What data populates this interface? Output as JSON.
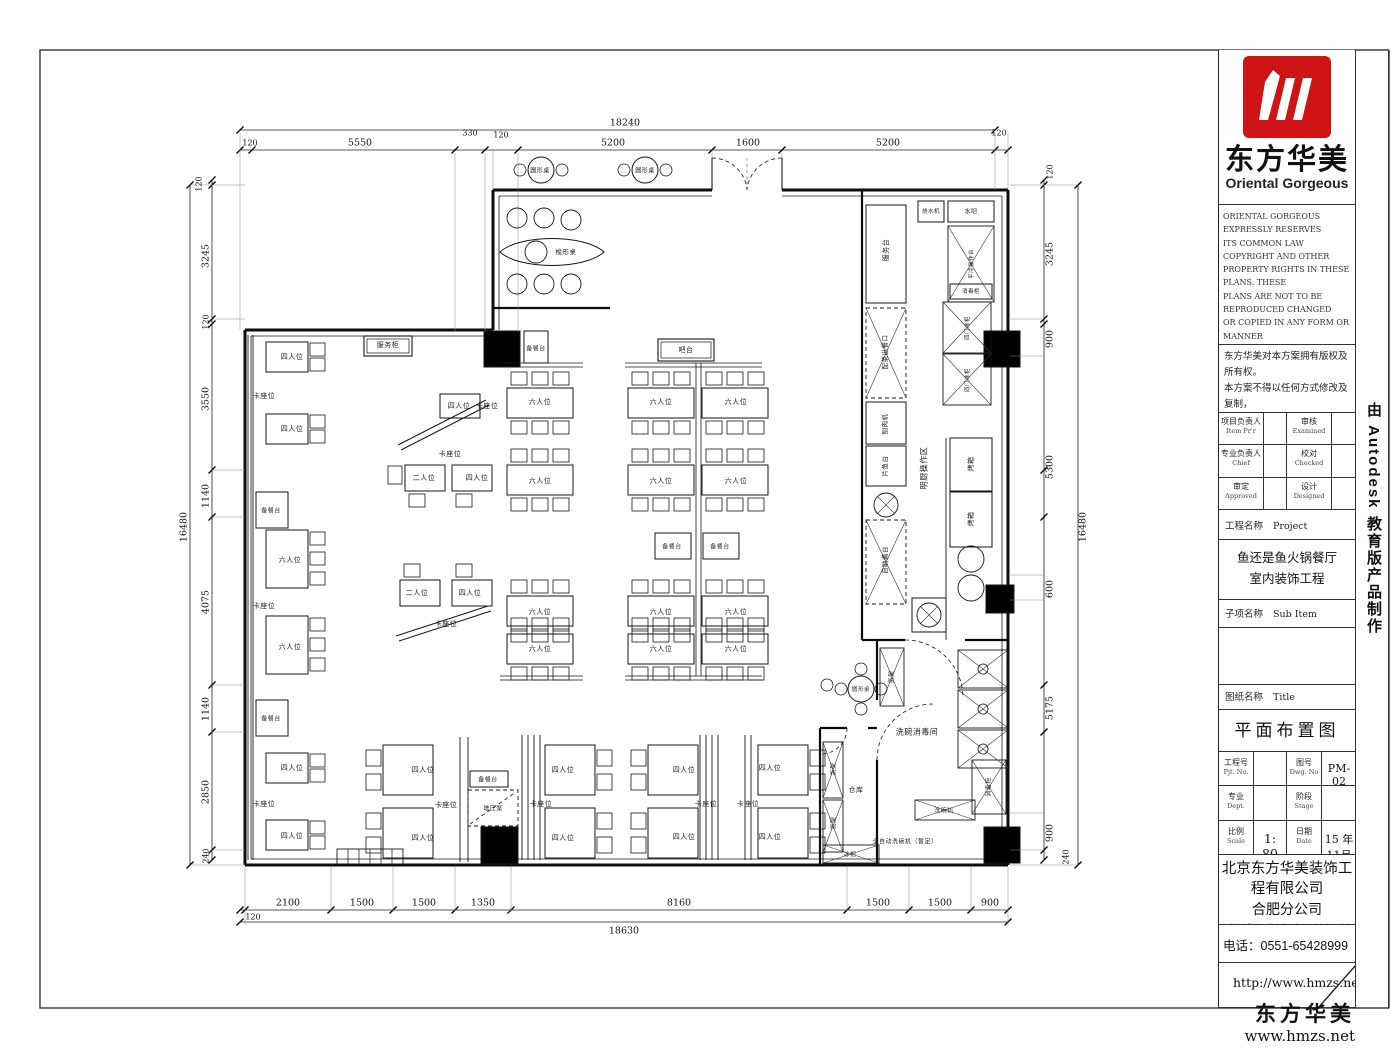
{
  "colors": {
    "logo_red": "#ce1414"
  },
  "sheet": {
    "brand": {
      "logo_cn": "东方华美",
      "logo_en": "Oriental Gorgeous"
    },
    "copyright_en": [
      "ORIENTAL GORGEOUS EXPRESSLY RESERVES",
      "ITS COMMON LAW COPYRIGHT AND OTHER",
      "PROPERTY RIGHTS IN THESE PLANS. THESE",
      "PLANS ARE NOT TO BE REPRODUCED CHANGED",
      "OR COPIED IN ANY FORM OR MANNER",
      "WHATSOEVER. NOR ARE THEY TO BE ASSIGNED",
      "TO ANY THIRD PARTY WITHOUT FIRST",
      "OBTAINING THE EXPRESSED WRITTEN",
      "PERMISSION AND CONSENT OF ORIENTAL",
      "GORGEOUS"
    ],
    "copyright_cn": [
      "东方华美对本方案拥有版权及所有权。",
      "本方案不得以任何方式修改及复制，",
      "未经东方华美书面授权，本方案不得",
      "向任何第三方转让。"
    ],
    "approvals": {
      "r1c1_cn": "项目负责人",
      "r1c1_en": "Item Pr'r",
      "r1c2_cn": "审核",
      "r1c2_en": "Examined",
      "r2c1_cn": "专业负责人",
      "r2c1_en": "Chief",
      "r2c2_cn": "校对",
      "r2c2_en": "Checked",
      "r3c1_cn": "审定",
      "r3c1_en": "Approved",
      "r3c2_cn": "设计",
      "r3c2_en": "Designed"
    },
    "project": {
      "label_cn": "工程名称",
      "label_en": "Project",
      "name_line1": "鱼还是鱼火锅餐厅",
      "name_line2": "室内装饰工程"
    },
    "subitem": {
      "label_cn": "子项名称",
      "label_en": "Sub Item"
    },
    "sheet_title": {
      "label_cn": "图纸名称",
      "label_en": "Title",
      "value": "平面布置图"
    },
    "fields": {
      "pjt_cn": "工程号",
      "pjt_en": "Pjt. No.",
      "pjt_val": "",
      "dwg_cn": "图号",
      "dwg_en": "Dwg. No",
      "dwg_val": "PM-02",
      "dept_cn": "专业",
      "dept_en": "Dept.",
      "dept_val": "",
      "stage_cn": "阶段",
      "stage_en": "Stage",
      "stage_val": "",
      "scale_cn": "比例",
      "scale_en": "Scale",
      "scale_val": "1: 80",
      "date_cn": "日期",
      "date_en": "Date",
      "date_val": "15 年11月"
    },
    "company": {
      "name": "北京东方华美装饰工程有限公司",
      "branch": "合肥分公司",
      "address": "安徽省合肥市马鞍山路与南二环交汇处绿地赢海大厦8F 9楼",
      "phone": "电话：0551-65428999",
      "website": "http://www.hmzs.net"
    },
    "side_text": "由 Autodesk 教育版产品制作",
    "footer": {
      "brand": "东方华美",
      "url": "www.hmzs.net"
    }
  },
  "plan": {
    "labels": [
      [
        "圆形桌",
        540,
        170,
        0,
        6
      ],
      [
        "圆形桌",
        645,
        170,
        0,
        6
      ],
      [
        "梭形桌",
        566,
        251,
        0,
        6.5
      ],
      [
        "服务柜",
        388,
        345,
        0,
        7
      ],
      [
        "吧台",
        686,
        350,
        0,
        7
      ],
      [
        "四人位",
        292,
        357
      ],
      [
        "卡座位",
        264,
        396
      ],
      [
        "四人位",
        292,
        429
      ],
      [
        "备餐台",
        271,
        510,
        0,
        6
      ],
      [
        "六人位",
        290,
        560
      ],
      [
        "卡座位",
        264,
        606
      ],
      [
        "六人位",
        290,
        647
      ],
      [
        "备餐台",
        271,
        718,
        0,
        6
      ],
      [
        "四人位",
        292,
        768
      ],
      [
        "卡座位",
        264,
        804
      ],
      [
        "四人位",
        292,
        836
      ],
      [
        "四人位",
        459,
        406
      ],
      [
        "卡座位",
        487,
        406
      ],
      [
        "卡座位",
        450,
        454
      ],
      [
        "二人位",
        424,
        478
      ],
      [
        "四人位",
        477,
        478
      ],
      [
        "二人位",
        417,
        593
      ],
      [
        "四人位",
        470,
        593
      ],
      [
        "卡座位",
        446,
        624
      ],
      [
        "备餐台",
        536,
        348,
        0,
        6
      ],
      [
        "六人位",
        540,
        402
      ],
      [
        "六人位",
        661,
        402
      ],
      [
        "六人位",
        736,
        402
      ],
      [
        "六人位",
        540,
        481
      ],
      [
        "六人位",
        661,
        481
      ],
      [
        "六人位",
        736,
        481
      ],
      [
        "备餐台",
        672,
        546,
        0,
        6
      ],
      [
        "备餐台",
        720,
        546,
        0,
        6
      ],
      [
        "六人位",
        540,
        612
      ],
      [
        "六人位",
        661,
        612
      ],
      [
        "六人位",
        736,
        612
      ],
      [
        "六人位",
        540,
        649
      ],
      [
        "六人位",
        661,
        649
      ],
      [
        "六人位",
        736,
        649
      ],
      [
        "服务台",
        886,
        250,
        -90,
        7
      ],
      [
        "烧水机",
        931,
        211,
        0,
        5.5
      ],
      [
        "水吧",
        971,
        211,
        0,
        6
      ],
      [
        "平冷操作台",
        971,
        264,
        -90,
        5.5
      ],
      [
        "消毒柜",
        971,
        291,
        0,
        5.5
      ],
      [
        "四门冰柜",
        967,
        328,
        -90,
        5.5
      ],
      [
        "四门冰柜",
        967,
        380,
        -90,
        5.5
      ],
      [
        "配菜出餐口",
        884,
        352,
        -90,
        6.5
      ],
      [
        "刨肉机",
        884,
        424,
        -90,
        6.5
      ],
      [
        "片鱼台",
        884,
        466,
        -90,
        6.5
      ],
      [
        "明厨操作区",
        924,
        468,
        -90,
        8
      ],
      [
        "自助酱台",
        884,
        560,
        -90,
        6.5
      ],
      [
        "烤箱",
        971,
        464,
        -90,
        7
      ],
      [
        "烤箱",
        971,
        519,
        -90,
        7
      ],
      [
        "洗碗消毒间",
        917,
        732,
        0,
        8
      ],
      [
        "货架",
        891,
        677,
        -90,
        6
      ],
      [
        "圆形桌",
        861,
        689,
        0,
        5.5
      ],
      [
        "消毒柜",
        988,
        787,
        -90,
        6
      ],
      [
        "洗碗机",
        944,
        810,
        0,
        6
      ],
      [
        "全自动洗碗机（暂定）",
        905,
        841,
        0,
        6
      ],
      [
        "仓库",
        856,
        790,
        0,
        7
      ],
      [
        "货架",
        833,
        769,
        -90,
        6
      ],
      [
        "货架",
        833,
        823,
        -90,
        6
      ],
      [
        "冰柜",
        850,
        854,
        0,
        6
      ],
      [
        "四人位",
        423,
        770
      ],
      [
        "卡座位",
        446,
        805
      ],
      [
        "四人位",
        423,
        838
      ],
      [
        "备餐台",
        488,
        779,
        0,
        6
      ],
      [
        "增压泵",
        493,
        808,
        0,
        6
      ],
      [
        "四人位",
        563,
        770
      ],
      [
        "卡座位",
        541,
        804
      ],
      [
        "四人位",
        563,
        838
      ],
      [
        "四人位",
        684,
        770
      ],
      [
        "卡座位",
        706,
        804
      ],
      [
        "四人位",
        684,
        837
      ],
      [
        "卡座位",
        748,
        804
      ],
      [
        "四人位",
        770,
        768
      ],
      [
        "四人位",
        770,
        837
      ]
    ],
    "dims": [
      [
        "18240",
        625,
        123
      ],
      [
        "120",
        250,
        143,
        0,
        8
      ],
      [
        "5550",
        360,
        143
      ],
      [
        "330",
        470,
        133,
        0,
        8
      ],
      [
        "120",
        501,
        135,
        0,
        8
      ],
      [
        "5200",
        613,
        143
      ],
      [
        "1600",
        748,
        143
      ],
      [
        "5200",
        888,
        143
      ],
      [
        "120",
        999,
        133,
        0,
        8
      ],
      [
        "16480",
        184,
        527,
        -90
      ],
      [
        "120",
        199,
        184,
        -90,
        8
      ],
      [
        "3245",
        206,
        256,
        -90
      ],
      [
        "120",
        206,
        322,
        -90,
        8
      ],
      [
        "3550",
        206,
        399,
        -90
      ],
      [
        "1140",
        206,
        496,
        -90
      ],
      [
        "4075",
        206,
        602,
        -90
      ],
      [
        "1140",
        206,
        709,
        -90
      ],
      [
        "2850",
        206,
        792,
        -90
      ],
      [
        "240",
        206,
        856,
        -90,
        8
      ],
      [
        "16480",
        1083,
        527,
        -90
      ],
      [
        "120",
        1050,
        172,
        -90,
        8
      ],
      [
        "3245",
        1050,
        254,
        -90
      ],
      [
        "900",
        1050,
        339,
        -90
      ],
      [
        "5300",
        1050,
        467,
        -90
      ],
      [
        "600",
        1050,
        589,
        -90
      ],
      [
        "5175",
        1050,
        708,
        -90
      ],
      [
        "900",
        1050,
        833,
        -90
      ],
      [
        "240",
        1066,
        857,
        -90,
        8
      ],
      [
        "2100",
        288,
        903
      ],
      [
        "1500",
        362,
        903
      ],
      [
        "1500",
        424,
        903
      ],
      [
        "1350",
        483,
        903
      ],
      [
        "8160",
        679,
        903
      ],
      [
        "1500",
        878,
        903
      ],
      [
        "1500",
        940,
        903
      ],
      [
        "900",
        990,
        903
      ],
      [
        "120",
        253,
        917,
        0,
        8
      ],
      [
        "18630",
        624,
        931
      ]
    ]
  }
}
